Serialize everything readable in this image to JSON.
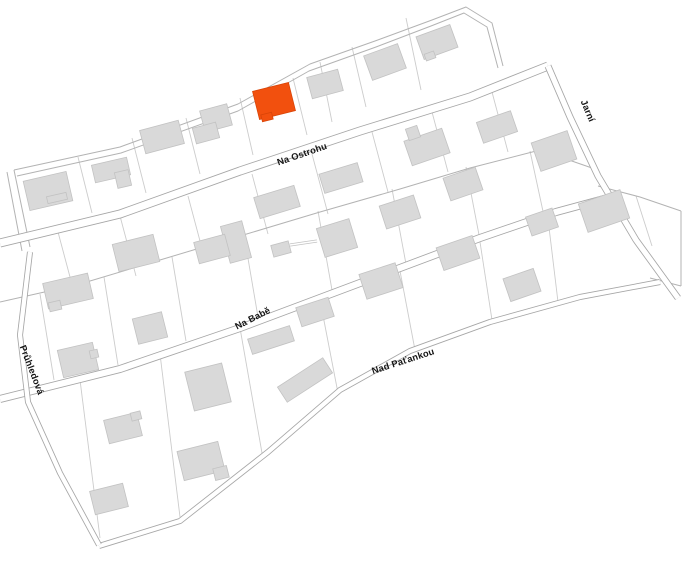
{
  "map": {
    "title": "cadastral-parcel-map",
    "background": "#ffffff",
    "colors": {
      "parcel_line": "#cccccc",
      "boundary_line": "#b3b3b3",
      "street_edge": "#a6a6a6",
      "street_fill": "#ffffff",
      "building_fill": "#d9d9d9",
      "building_stroke": "#c2c2c2",
      "highlight_fill": "#f2500e",
      "highlight_stroke": "#d94508",
      "label_color": "#141414"
    },
    "streets": [
      {
        "slug": "na-ostrohu",
        "name": "Na Ostrohu",
        "width": 9,
        "path": [
          [
            0,
            243
          ],
          [
            120,
            214
          ],
          [
            240,
            171
          ],
          [
            360,
            131
          ],
          [
            470,
            97
          ],
          [
            548,
            66
          ]
        ],
        "label": {
          "x": 303,
          "y": 157,
          "angle": -19
        }
      },
      {
        "slug": "jarni",
        "name": "Jarní",
        "width": 7,
        "path": [
          [
            548,
            66
          ],
          [
            570,
            117
          ],
          [
            598,
            176
          ],
          [
            636,
            240
          ],
          [
            678,
            298
          ]
        ],
        "label": {
          "x": 585,
          "y": 112,
          "angle": 67
        }
      },
      {
        "slug": "na-babe",
        "name": "Na Babě",
        "width": 8,
        "path": [
          [
            0,
            399
          ],
          [
            120,
            369
          ],
          [
            240,
            328
          ],
          [
            360,
            283
          ],
          [
            480,
            238
          ],
          [
            556,
            212
          ],
          [
            604,
            199
          ]
        ],
        "label": {
          "x": 254,
          "y": 321,
          "angle": -27
        }
      },
      {
        "slug": "nad-patankou",
        "name": "Nad Paťankou",
        "width": 6,
        "path": [
          [
            99,
            546
          ],
          [
            180,
            521
          ],
          [
            268,
            452
          ],
          [
            340,
            390
          ],
          [
            410,
            351
          ],
          [
            490,
            322
          ],
          [
            580,
            297
          ],
          [
            660,
            282
          ]
        ],
        "label": {
          "x": 404,
          "y": 364,
          "angle": -18
        }
      },
      {
        "slug": "pruhledova",
        "name": "Průhledová",
        "width": 6,
        "path": [
          [
            30,
            252
          ],
          [
            20,
            335
          ],
          [
            28,
            402
          ],
          [
            60,
            473
          ],
          [
            99,
            545
          ]
        ],
        "label": {
          "x": 29,
          "y": 371,
          "angle": 69
        }
      }
    ],
    "boundaries": [
      [
        [
          14,
          170
        ],
        [
          120,
          147
        ],
        [
          238,
          104
        ],
        [
          310,
          64
        ],
        [
          375,
          41
        ],
        [
          432,
          20
        ],
        [
          466,
          7
        ],
        [
          492,
          23
        ],
        [
          503,
          66
        ]
      ],
      [
        [
          17,
          176
        ],
        [
          121,
          153
        ],
        [
          238,
          111
        ],
        [
          309,
          71
        ],
        [
          376,
          47
        ],
        [
          431,
          26
        ],
        [
          464,
          13
        ],
        [
          487,
          27
        ],
        [
          498,
          68
        ]
      ],
      [
        [
          14,
          170
        ],
        [
          30,
          247
        ]
      ],
      [
        [
          7,
          172
        ],
        [
          22,
          251
        ]
      ],
      [
        [
          0,
          302
        ],
        [
          80,
          284
        ],
        [
          160,
          260
        ],
        [
          240,
          236
        ],
        [
          320,
          212
        ],
        [
          400,
          189
        ],
        [
          470,
          168
        ],
        [
          540,
          150
        ],
        [
          592,
          168
        ]
      ],
      [
        [
          598,
          186
        ],
        [
          640,
          197
        ],
        [
          681,
          211
        ]
      ],
      [
        [
          681,
          211
        ],
        [
          681,
          286
        ]
      ],
      [
        [
          650,
          278
        ],
        [
          681,
          286
        ]
      ]
    ],
    "parcel_lines": [
      [
        78,
        157,
        92,
        213
      ],
      [
        132,
        138,
        146,
        193
      ],
      [
        186,
        118,
        200,
        174
      ],
      [
        240,
        98,
        253,
        155
      ],
      [
        293,
        78,
        307,
        135
      ],
      [
        320,
        62,
        332,
        122
      ],
      [
        352,
        47,
        366,
        107
      ],
      [
        406,
        18,
        421,
        90
      ],
      [
        58,
        232,
        74,
        292
      ],
      [
        120,
        216,
        136,
        276
      ],
      [
        188,
        196,
        204,
        256
      ],
      [
        252,
        174,
        268,
        234
      ],
      [
        312,
        154,
        328,
        214
      ],
      [
        372,
        132,
        388,
        192
      ],
      [
        432,
        112,
        448,
        172
      ],
      [
        492,
        92,
        508,
        152
      ],
      [
        40,
        294,
        54,
        380
      ],
      [
        104,
        277,
        118,
        365
      ],
      [
        172,
        257,
        186,
        341
      ],
      [
        244,
        235,
        258,
        317
      ],
      [
        318,
        211,
        332,
        290
      ],
      [
        392,
        189,
        406,
        264
      ],
      [
        466,
        167,
        480,
        240
      ],
      [
        530,
        151,
        544,
        216
      ],
      [
        80,
        380,
        100,
        538
      ],
      [
        160,
        354,
        180,
        517
      ],
      [
        240,
        328,
        262,
        453
      ],
      [
        320,
        300,
        338,
        393
      ],
      [
        400,
        271,
        415,
        350
      ],
      [
        480,
        242,
        492,
        320
      ],
      [
        548,
        219,
        558,
        302
      ],
      [
        636,
        196,
        652,
        246
      ]
    ],
    "connectors": [
      [
        [
          290,
          245
        ],
        [
          317,
          241
        ]
      ]
    ],
    "buildings": [
      {
        "x": 48,
        "y": 191,
        "w": 44,
        "h": 30,
        "a": -13
      },
      {
        "x": 111,
        "y": 170,
        "w": 36,
        "h": 18,
        "a": -13
      },
      {
        "x": 123,
        "y": 179,
        "w": 14,
        "h": 16,
        "a": -13
      },
      {
        "x": 162,
        "y": 137,
        "w": 40,
        "h": 24,
        "a": -15
      },
      {
        "x": 216,
        "y": 118,
        "w": 28,
        "h": 22,
        "a": -15
      },
      {
        "x": 206,
        "y": 133,
        "w": 24,
        "h": 16,
        "a": -15
      },
      {
        "x": 325,
        "y": 84,
        "w": 32,
        "h": 22,
        "a": -15
      },
      {
        "x": 385,
        "y": 62,
        "w": 36,
        "h": 26,
        "a": -20
      },
      {
        "x": 437,
        "y": 42,
        "w": 36,
        "h": 24,
        "a": -20
      },
      {
        "x": 277,
        "y": 202,
        "w": 42,
        "h": 22,
        "a": -17
      },
      {
        "x": 341,
        "y": 178,
        "w": 40,
        "h": 20,
        "a": -17
      },
      {
        "x": 427,
        "y": 147,
        "w": 40,
        "h": 26,
        "a": -19
      },
      {
        "x": 497,
        "y": 127,
        "w": 36,
        "h": 22,
        "a": -19
      },
      {
        "x": 554,
        "y": 151,
        "w": 38,
        "h": 30,
        "a": -19
      },
      {
        "x": 236,
        "y": 242,
        "w": 22,
        "h": 38,
        "a": -15
      },
      {
        "x": 212,
        "y": 249,
        "w": 32,
        "h": 22,
        "a": -15
      },
      {
        "x": 281,
        "y": 249,
        "w": 18,
        "h": 12,
        "a": -15
      },
      {
        "x": 337,
        "y": 238,
        "w": 34,
        "h": 30,
        "a": -17
      },
      {
        "x": 400,
        "y": 212,
        "w": 36,
        "h": 24,
        "a": -18
      },
      {
        "x": 463,
        "y": 184,
        "w": 34,
        "h": 24,
        "a": -19
      },
      {
        "x": 68,
        "y": 291,
        "w": 46,
        "h": 26,
        "a": -13
      },
      {
        "x": 136,
        "y": 253,
        "w": 42,
        "h": 28,
        "a": -14
      },
      {
        "x": 150,
        "y": 328,
        "w": 30,
        "h": 26,
        "a": -14
      },
      {
        "x": 78,
        "y": 360,
        "w": 36,
        "h": 28,
        "a": -13
      },
      {
        "x": 542,
        "y": 222,
        "w": 28,
        "h": 20,
        "a": -19
      },
      {
        "x": 604,
        "y": 211,
        "w": 44,
        "h": 30,
        "a": -19
      },
      {
        "x": 208,
        "y": 387,
        "w": 38,
        "h": 40,
        "a": -14
      },
      {
        "x": 305,
        "y": 380,
        "w": 54,
        "h": 18,
        "a": -33
      },
      {
        "x": 271,
        "y": 340,
        "w": 44,
        "h": 16,
        "a": -18
      },
      {
        "x": 315,
        "y": 312,
        "w": 34,
        "h": 20,
        "a": -18
      },
      {
        "x": 381,
        "y": 281,
        "w": 38,
        "h": 26,
        "a": -18
      },
      {
        "x": 458,
        "y": 253,
        "w": 38,
        "h": 24,
        "a": -19
      },
      {
        "x": 522,
        "y": 285,
        "w": 32,
        "h": 24,
        "a": -19
      },
      {
        "x": 123,
        "y": 428,
        "w": 34,
        "h": 24,
        "a": -14
      },
      {
        "x": 201,
        "y": 461,
        "w": 42,
        "h": 30,
        "a": -14
      },
      {
        "x": 109,
        "y": 499,
        "w": 34,
        "h": 24,
        "a": -14
      }
    ],
    "building_annexes": [
      {
        "x": 57,
        "y": 198,
        "w": 20,
        "h": 7,
        "a": -13
      },
      {
        "x": 430,
        "y": 56,
        "w": 10,
        "h": 7,
        "a": -20
      },
      {
        "x": 413,
        "y": 133,
        "w": 12,
        "h": 12,
        "a": -19
      },
      {
        "x": 55,
        "y": 306,
        "w": 12,
        "h": 9,
        "a": -13
      },
      {
        "x": 94,
        "y": 354,
        "w": 8,
        "h": 8,
        "a": -13
      },
      {
        "x": 136,
        "y": 416,
        "w": 10,
        "h": 8,
        "a": -14
      },
      {
        "x": 221,
        "y": 473,
        "w": 14,
        "h": 12,
        "a": -14
      }
    ],
    "highlighted_building": {
      "parts": [
        {
          "x": 274,
          "y": 101,
          "w": 37,
          "h": 29,
          "a": -14
        },
        {
          "x": 267,
          "y": 117,
          "w": 11,
          "h": 7,
          "a": -14
        }
      ]
    }
  }
}
